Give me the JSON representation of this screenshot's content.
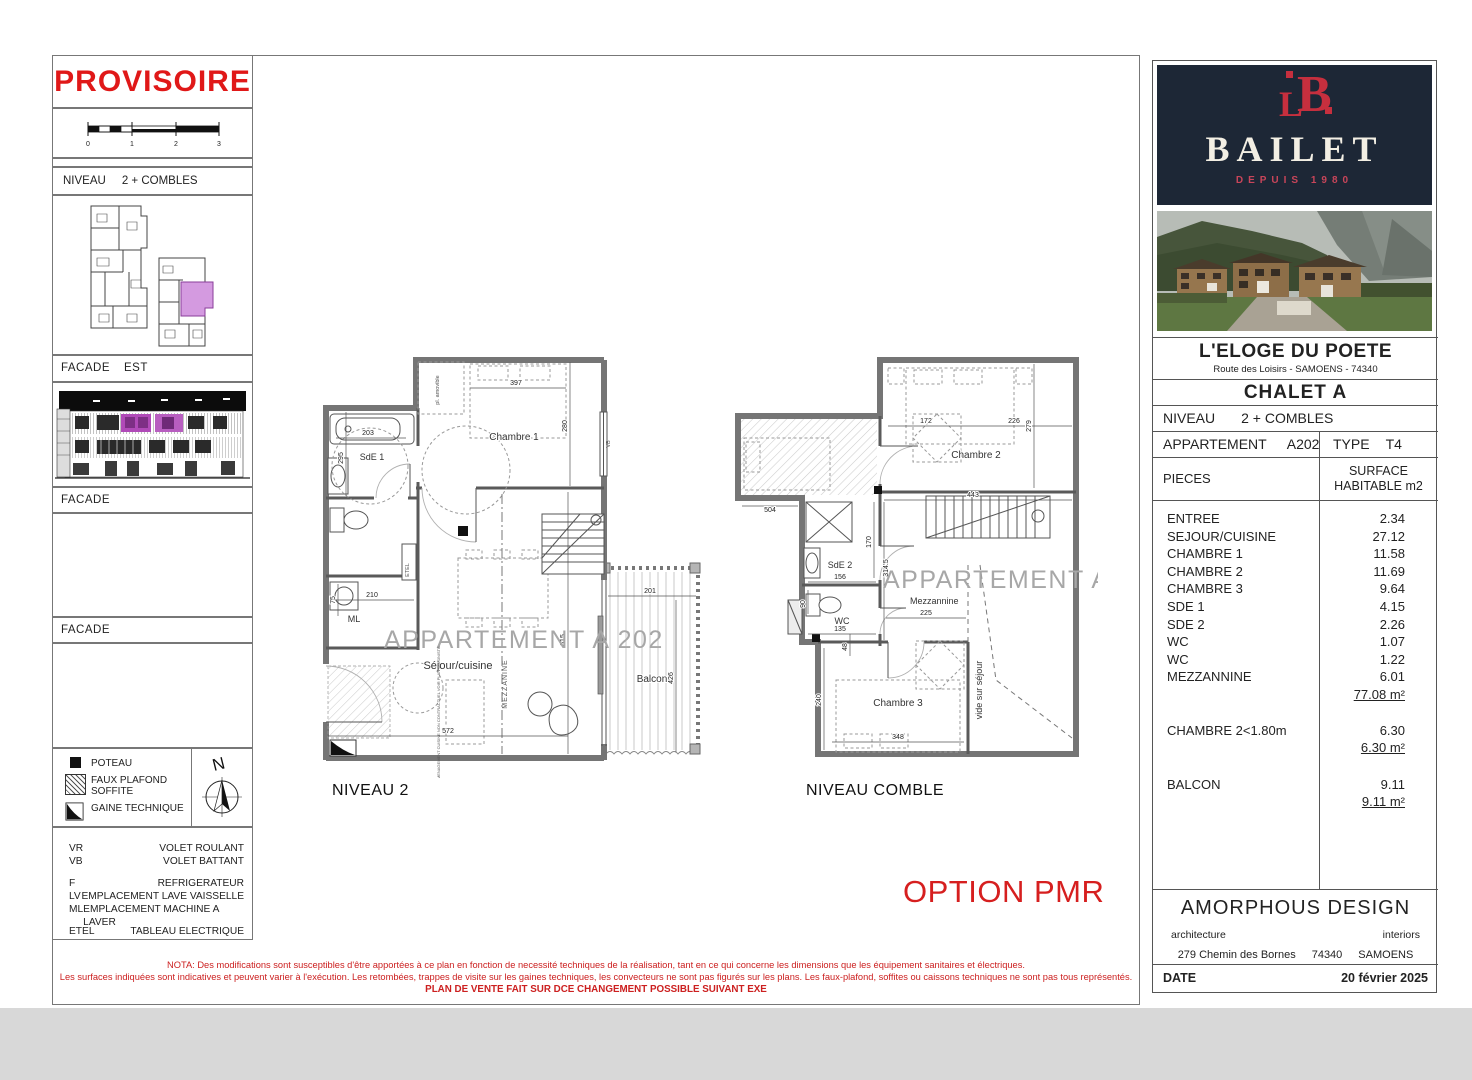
{
  "colors": {
    "accent_red": "#d61f1f",
    "logo_navy": "#1d2736",
    "logo_red": "#c62f3e",
    "highlight_pink": "#d49ae0",
    "facade_magenta": "#b04ab8",
    "wall_gray": "#757575",
    "watermark_gray": "#a7a7a7"
  },
  "left_panel": {
    "provisoire": "PROVISOIRE",
    "scale_ticks": [
      "0",
      "1",
      "2",
      "3"
    ],
    "niveau_label": "NIVEAU",
    "niveau_value": "2 + COMBLES",
    "facade_est_label": "FACADE",
    "facade_est_value": "EST",
    "facade_2": "FACADE",
    "facade_3": "FACADE",
    "legend": [
      {
        "label": "POTEAU"
      },
      {
        "label": "FAUX PLAFOND SOFFITE"
      },
      {
        "label": "GAINE TECHNIQUE"
      }
    ],
    "north": "N",
    "abbreviations": [
      {
        "abbr": "VR",
        "label": "VOLET ROULANT"
      },
      {
        "abbr": "VB",
        "label": "VOLET BATTANT"
      },
      {
        "abbr": "F",
        "label": "REFRIGERATEUR"
      },
      {
        "abbr": "LV",
        "label": "EMPLACEMENT LAVE VAISSELLE"
      },
      {
        "abbr": "ML",
        "label": "EMPLACEMENT MACHINE A LAVER"
      },
      {
        "abbr": "ETEL",
        "label": "TABLEAU ELECTRIQUE"
      }
    ]
  },
  "plans": {
    "option_pmr": "OPTION PMR",
    "niveau2": {
      "title": "NIVEAU 2",
      "watermark": "APPARTEMENT A 202",
      "labels": {
        "sde1": "SdE 1",
        "chambre1": "Chambre 1",
        "sejour": "Séjour/cuisine",
        "balcon": "Balcon",
        "ml": "ML",
        "etel": "ETEL",
        "mezzanine": "MEZZANINE",
        "vb": "VB",
        "placard": "pl. amovible",
        "kitchen_note": "AMENAGEMENT CUISINE NON CONTRACTUEL VOIR PLAN CUISINISTE"
      },
      "dims": {
        "bath": "203",
        "sde1_h": "295",
        "bed": "397",
        "ch1_h": "280",
        "hall": "210",
        "hall_h": "75",
        "sejour_h": "615",
        "sejour_w": "572",
        "balcon_w": "201",
        "balcon_h": "426"
      }
    },
    "comble": {
      "title": "NIVEAU COMBLE",
      "watermark": "APPARTEMENT A 202",
      "labels": {
        "chambre2": "Chambre 2",
        "sde2": "SdE 2",
        "wc": "WC",
        "mezzannine": "Mezzannine",
        "chambre3": "Chambre 3",
        "vide": "vide sur séjour"
      },
      "dims": {
        "ch2_a": "172",
        "ch2_b": "226",
        "ch2_h": "279",
        "wing": "504",
        "mezz_w": "443",
        "mezz_h": "314.5",
        "sde2_w": "156",
        "sde2_h": "170",
        "wc_w": "135",
        "wc_h": "90",
        "mezz_b": "225",
        "ch3_a": "48",
        "ch3_h": "240",
        "ch3_w": "348"
      }
    }
  },
  "titleblock": {
    "logo": {
      "mono_l": "L",
      "mono_b": "B",
      "name": "BAILET",
      "tagline": "DEPUIS 1980"
    },
    "project": "L'ELOGE DU POETE",
    "address": "Route des Loisirs - SAMOENS - 74340",
    "chalet": "CHALET A",
    "niveau_label": "NIVEAU",
    "niveau_value": "2 + COMBLES",
    "apt_label": "APPARTEMENT",
    "apt_value": "A202",
    "type_label": "TYPE",
    "type_value": "T4",
    "pieces_label": "PIECES",
    "surface_label_1": "SURFACE",
    "surface_label_2": "HABITABLE m2",
    "rooms": [
      {
        "name": "ENTREE",
        "value": "2.34"
      },
      {
        "name": "SEJOUR/CUISINE",
        "value": "27.12"
      },
      {
        "name": "CHAMBRE 1",
        "value": "11.58"
      },
      {
        "name": "CHAMBRE 2",
        "value": "11.69"
      },
      {
        "name": "CHAMBRE 3",
        "value": "9.64"
      },
      {
        "name": "SDE 1",
        "value": "4.15"
      },
      {
        "name": "SDE 2",
        "value": "2.26"
      },
      {
        "name": "WC",
        "value": "1.07"
      },
      {
        "name": "WC",
        "value": "1.22"
      },
      {
        "name": "MEZZANNINE",
        "value": "6.01"
      }
    ],
    "total": "77.08 m²",
    "attic_name": "CHAMBRE 2<1.80m",
    "attic_value": "6.30",
    "attic_total": "6.30 m²",
    "balcon_name": "BALCON",
    "balcon_value": "9.11",
    "balcon_total": "9.11 m²",
    "designer": "AMORPHOUS DESIGN",
    "designer_left": "architecture",
    "designer_right": "interiors",
    "designer_addr_1": "279 Chemin des Bornes",
    "designer_addr_2": "74340",
    "designer_addr_3": "SAMOENS",
    "date_label": "DATE",
    "date_value": "20 février 2025"
  },
  "footer": {
    "nota1": "NOTA: Des modifications sont susceptibles d'être apportées à ce plan en fonction de necessité techniques de la réalisation, tant en ce qui concerne les dimensions que les équipement sanitaires et électriques.",
    "nota2": "Les surfaces indiquées sont indicatives et peuvent varier à l'exécution.  Les retombées, trappes de visite sur les gaines techniques, les convecteurs ne sont pas figurés sur les plans.  Les faux-plafond, soffites ou caissons techniques ne sont pas tous représentés.",
    "nota3": "PLAN DE VENTE FAIT SUR DCE CHANGEMENT POSSIBLE SUIVANT EXE"
  }
}
